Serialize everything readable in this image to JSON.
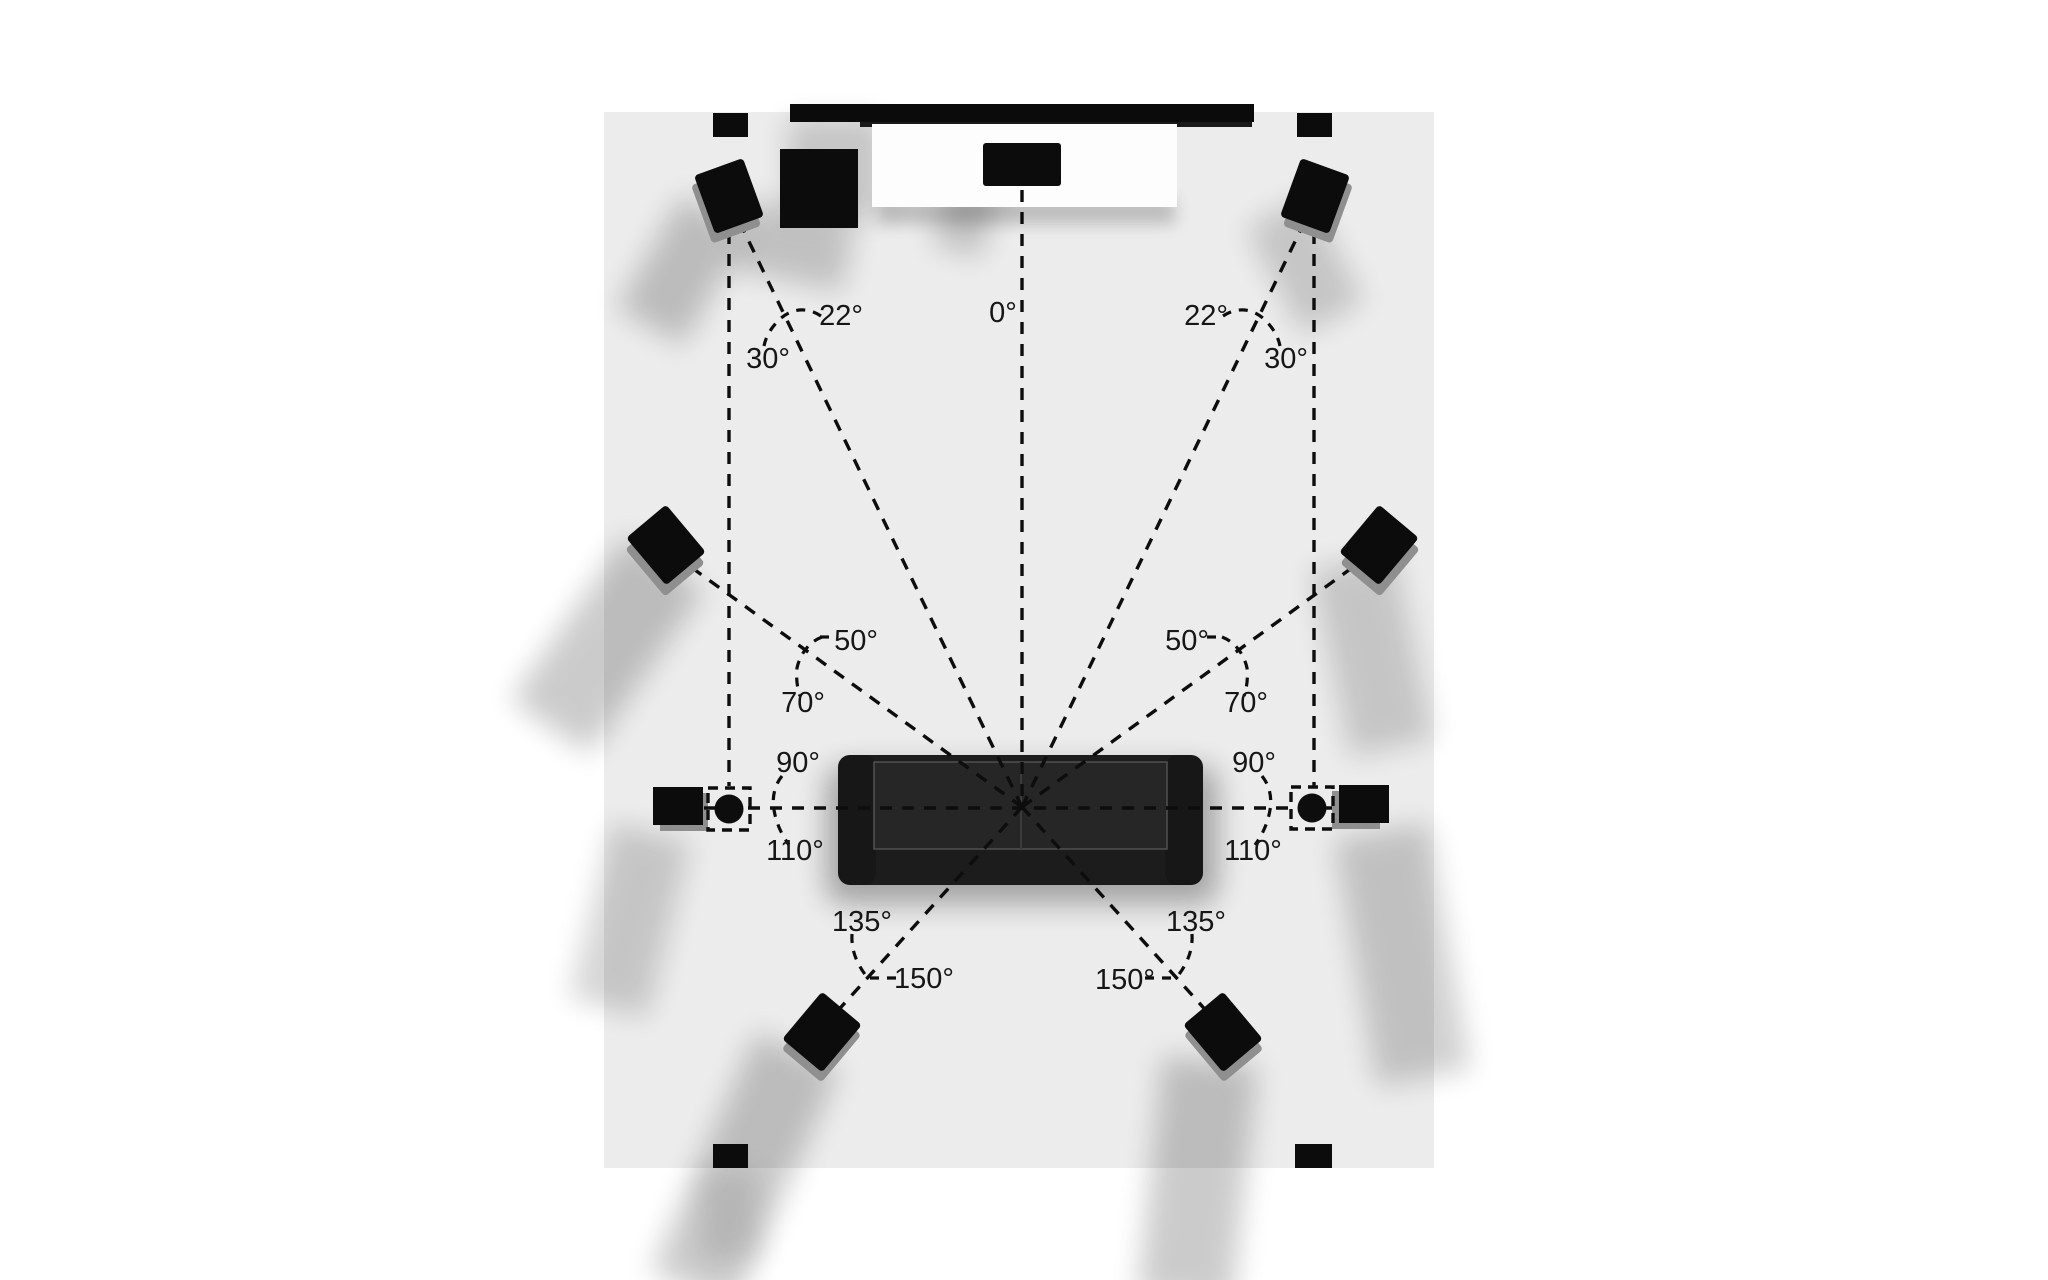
{
  "labels": {
    "center": "0°",
    "left": {
      "front_min": "22°",
      "front_max": "30°",
      "wide_min": "50°",
      "wide_max": "70°",
      "side_min": "90°",
      "side_max": "110°",
      "rear_min": "135°",
      "rear_max": "150°"
    },
    "right": {
      "front_min": "22°",
      "front_max": "30°",
      "wide_min": "50°",
      "wide_max": "70°",
      "side_min": "90°",
      "side_max": "110°",
      "rear_min": "135°",
      "rear_max": "150°"
    }
  },
  "colors": {
    "background": "#ffffff",
    "room": "#ececec",
    "line": "#0d0d0d",
    "speaker": "#0c0c0c",
    "speaker_stand": "#8f8f8f",
    "tv": "#0b0b0b",
    "console": "#fdfdfd",
    "sofa": "#1c1c1c",
    "sofa_seat": "#262626"
  }
}
